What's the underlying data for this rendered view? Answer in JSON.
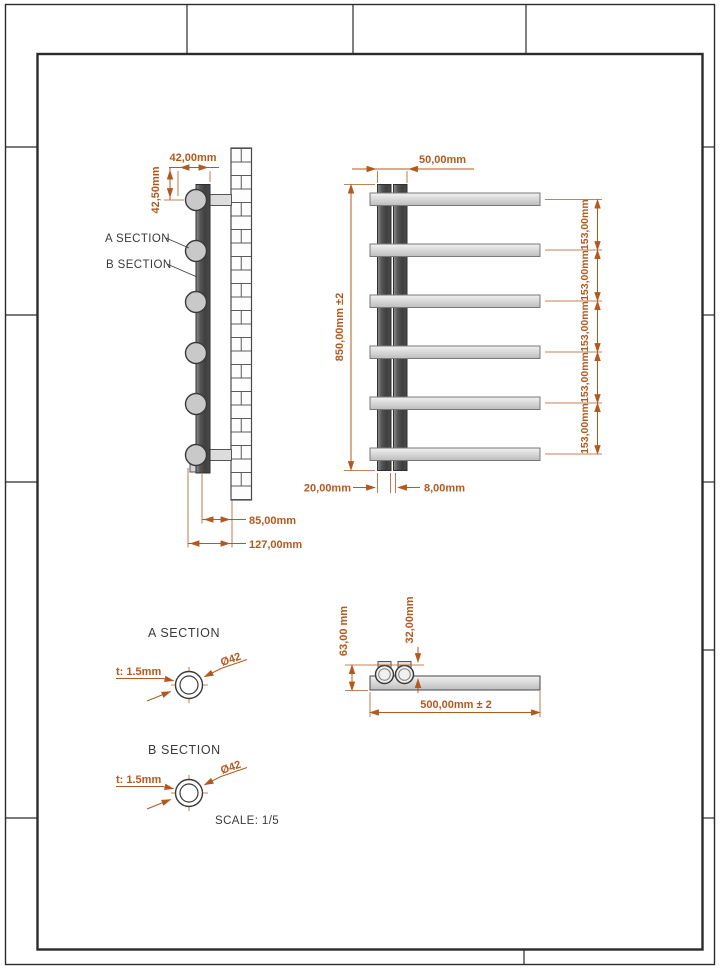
{
  "sheet": {
    "scale_note": "SCALE: 1/5"
  },
  "side_view": {
    "dim_width_top": "42,00mm",
    "dim_height_top": "42,50mm",
    "label_a": "A SECTION",
    "label_b": "B SECTION",
    "dim_depth_inner": "85,00mm",
    "dim_depth_total": "127,00mm"
  },
  "front_view": {
    "dim_tube_spacing": "50,00mm",
    "dim_height": "850,00mm ±2",
    "pitch": [
      "153,00mm",
      "153,00mm",
      "153,00mm",
      "153,00mm",
      "153,00mm"
    ],
    "dim_tube_width": "20,00mm",
    "dim_tube_gap": "8,00mm"
  },
  "top_view": {
    "dim_depth": "63,00 mm",
    "dim_valve_offset": "32,00mm",
    "dim_width": "500,00mm ± 2"
  },
  "section_a": {
    "title": "A SECTION",
    "thickness": "t: 1.5mm",
    "diameter": "Ø42"
  },
  "section_b": {
    "title": "B SECTION",
    "thickness": "t: 1.5mm",
    "diameter": "Ø42"
  }
}
